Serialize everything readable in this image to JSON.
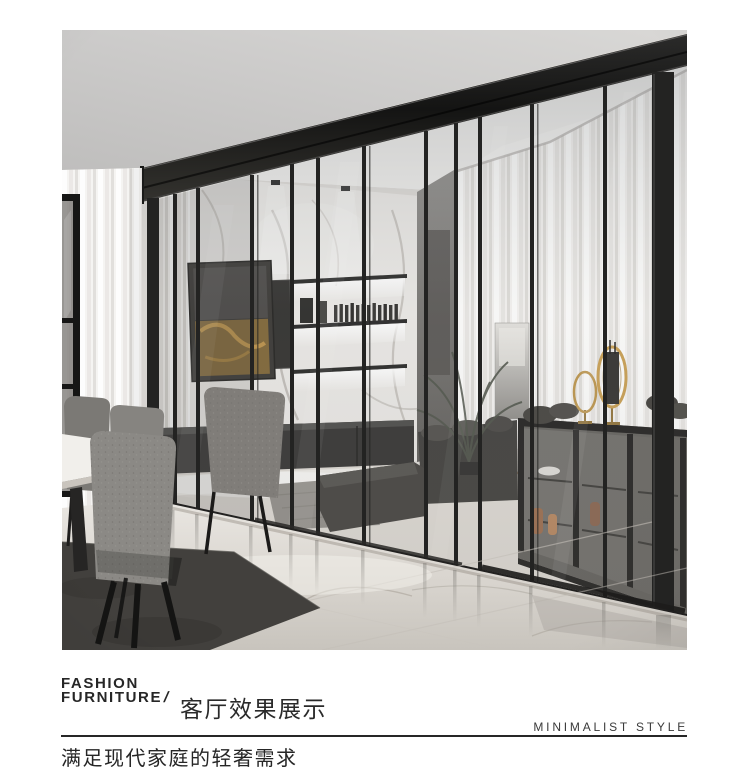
{
  "page": {
    "width": 750,
    "height": 778,
    "background": "#ffffff"
  },
  "photo": {
    "description": "Modern living room behind a black slim-framed glass sliding partition wall: marble feature wall with backlit display shelves, abstract gold artwork, dark media console, gray sofa and ottoman, glass-front sideboard with gold ring decor, sheer white curtains, gray dining chairs and marble table on a polished marble floor",
    "palette": {
      "frame_black": "#1c1c1b",
      "ceiling_gray": "#cbcac9",
      "interior_white": "#f3f2f0",
      "marble_wall": "#eae8e5",
      "curtain_white": "#f2f0ed",
      "floor_marble": "#dcd8d2",
      "rug_dark": "#42403d",
      "chair_gray": "#86847f",
      "gold_accent": "#c89d4f",
      "copper_vase": "#9a6a4a"
    }
  },
  "caption": {
    "brand_line1": "FASHION",
    "brand_line2": "FURNITURE",
    "brand_slash": "/",
    "title": "客厅效果展示",
    "style_label": "MINIMALIST STYLE",
    "subtitle": "满足现代家庭的轻奢需求"
  }
}
